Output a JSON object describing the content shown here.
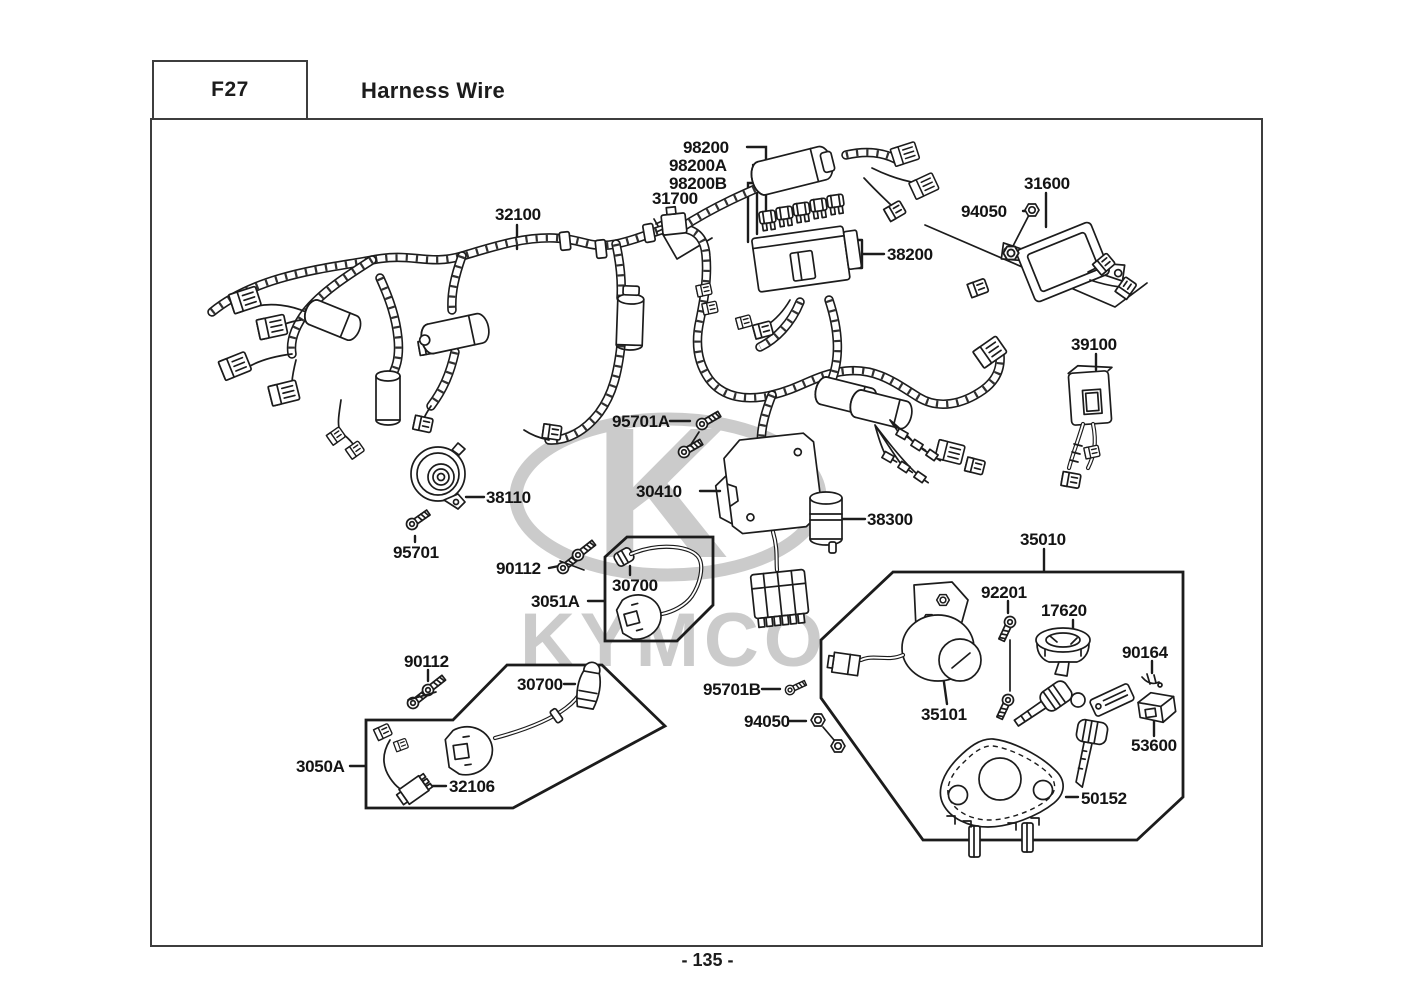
{
  "page": {
    "code": "F27",
    "title": "Harness Wire",
    "page_number": "- 135 -"
  },
  "watermark": {
    "brand": "KYMCO",
    "monogram": "K"
  },
  "colors": {
    "line": "#1c1c1c",
    "border": "#3d3d3d",
    "watermark": "#cbcbcb"
  },
  "part_labels": [
    {
      "id": "98200",
      "text": "98200",
      "x": 683,
      "y": 138
    },
    {
      "id": "98200a",
      "text": "98200A",
      "x": 669,
      "y": 156
    },
    {
      "id": "98200b",
      "text": "98200B",
      "x": 669,
      "y": 174
    },
    {
      "id": "31700",
      "text": "31700",
      "x": 652,
      "y": 189
    },
    {
      "id": "32100",
      "text": "32100",
      "x": 495,
      "y": 205
    },
    {
      "id": "31600",
      "text": "31600",
      "x": 1024,
      "y": 174
    },
    {
      "id": "94050-top",
      "text": "94050",
      "x": 961,
      "y": 202
    },
    {
      "id": "38200",
      "text": "38200",
      "x": 887,
      "y": 245
    },
    {
      "id": "39100",
      "text": "39100",
      "x": 1071,
      "y": 335
    },
    {
      "id": "95701a",
      "text": "95701A",
      "x": 612,
      "y": 412
    },
    {
      "id": "30410",
      "text": "30410",
      "x": 636,
      "y": 482
    },
    {
      "id": "38300",
      "text": "38300",
      "x": 867,
      "y": 510
    },
    {
      "id": "38110",
      "text": "38110",
      "x": 486,
      "y": 488
    },
    {
      "id": "95701",
      "text": "95701",
      "x": 393,
      "y": 543
    },
    {
      "id": "90112-upper",
      "text": "90112",
      "x": 496,
      "y": 559
    },
    {
      "id": "30700-upper",
      "text": "30700",
      "x": 612,
      "y": 576
    },
    {
      "id": "3051a",
      "text": "3051A",
      "x": 531,
      "y": 592
    },
    {
      "id": "90112-lower",
      "text": "90112",
      "x": 404,
      "y": 652
    },
    {
      "id": "30700-lower",
      "text": "30700",
      "x": 517,
      "y": 675
    },
    {
      "id": "3050a",
      "text": "3050A",
      "x": 296,
      "y": 757
    },
    {
      "id": "32106",
      "text": "32106",
      "x": 449,
      "y": 777
    },
    {
      "id": "35010",
      "text": "35010",
      "x": 1020,
      "y": 530
    },
    {
      "id": "92201",
      "text": "92201",
      "x": 981,
      "y": 583
    },
    {
      "id": "17620",
      "text": "17620",
      "x": 1041,
      "y": 601
    },
    {
      "id": "90164",
      "text": "90164",
      "x": 1122,
      "y": 643
    },
    {
      "id": "95701b",
      "text": "95701B",
      "x": 703,
      "y": 680
    },
    {
      "id": "94050-lower",
      "text": "94050",
      "x": 744,
      "y": 712
    },
    {
      "id": "35101",
      "text": "35101",
      "x": 921,
      "y": 705
    },
    {
      "id": "53600",
      "text": "53600",
      "x": 1131,
      "y": 736
    },
    {
      "id": "50152",
      "text": "50152",
      "x": 1081,
      "y": 789
    }
  ]
}
